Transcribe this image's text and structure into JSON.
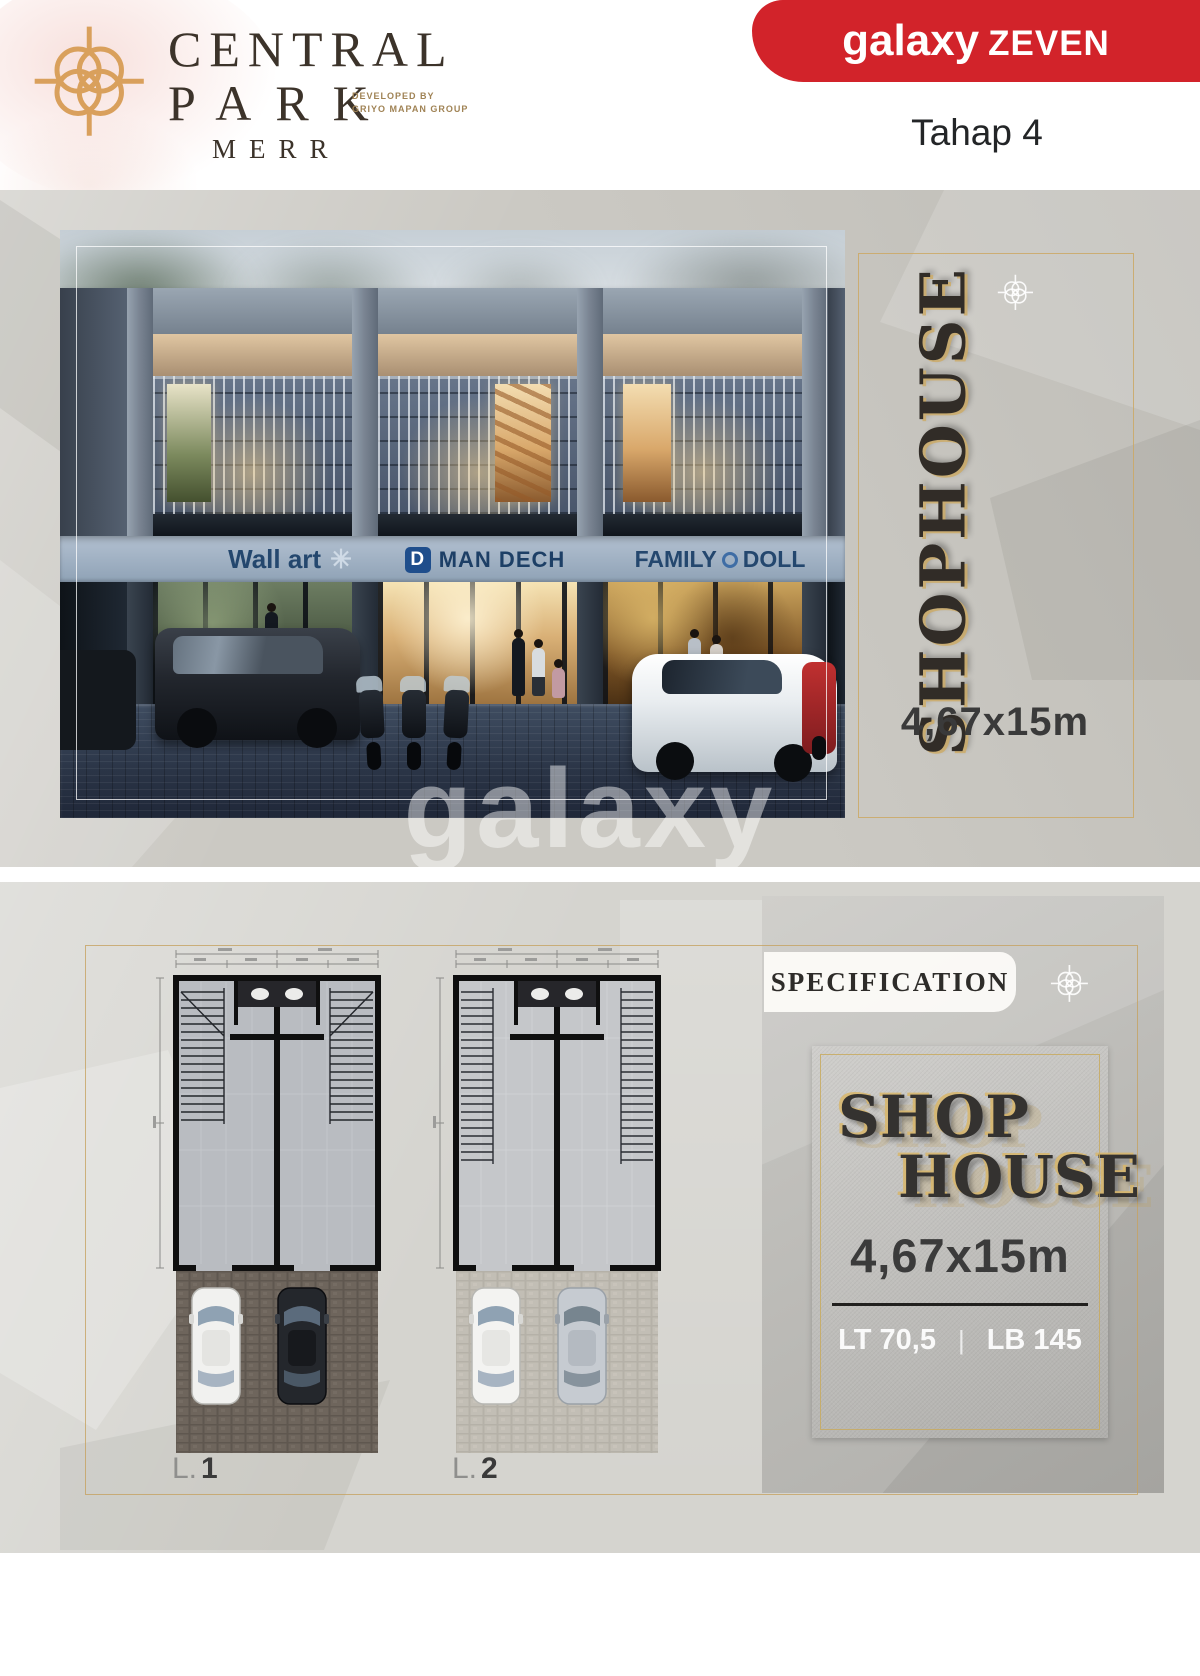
{
  "header": {
    "brand": {
      "name_line1": "CENTRAL",
      "name_line2": "PARK",
      "location": "MERR",
      "developer_line1": "DEVELOPED BY",
      "developer_line2": "GRIYO MAPAN GROUP"
    },
    "publisher": {
      "logo_primary": "galaxy",
      "logo_secondary": "ZEVEN",
      "phase_label": "Tahap 4"
    }
  },
  "hero": {
    "signs": {
      "shop1": "Wall art",
      "shop1_mark": "✳",
      "shop2_logo_letter": "D",
      "shop2": "MAN DECH",
      "shop3_word1": "FAMILY",
      "shop3_word2": "DOLL"
    },
    "side_panel": {
      "title": "SHOPHOUSE",
      "dimension": "4,67x15m"
    },
    "watermark": "galaxy"
  },
  "floor_plans": {
    "plan1_prefix": "L.",
    "plan1_number": "1",
    "plan2_prefix": "L.",
    "plan2_number": "2"
  },
  "specification": {
    "heading": "SPECIFICATION",
    "card": {
      "title_line1": "SHOP",
      "title_line2": "HOUSE",
      "dimension": "4,67x15m",
      "land_area": "LT 70,5",
      "separator": "|",
      "building_area": "LB 145"
    }
  },
  "colors": {
    "brand_red": "#d2232a",
    "accent_gold": "#c9a158",
    "sign_blue": "#2b4f7e"
  }
}
